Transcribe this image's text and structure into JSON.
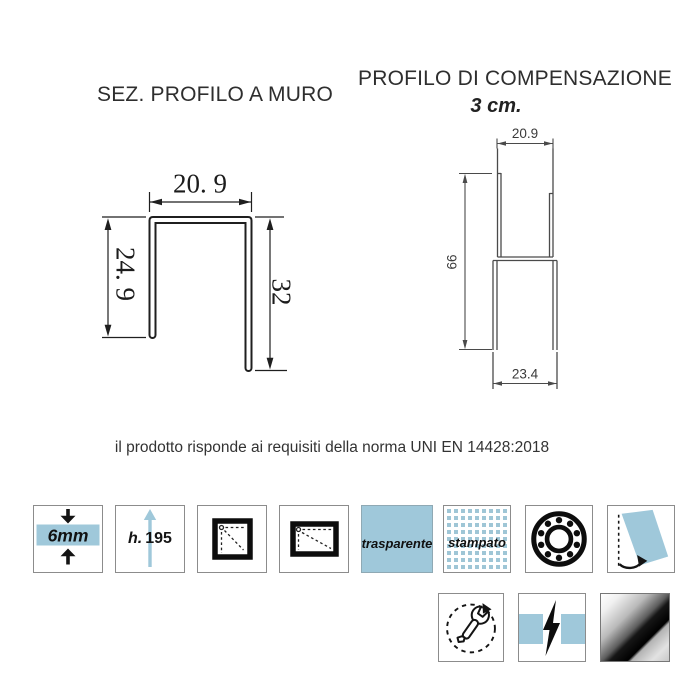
{
  "titles": {
    "left": "SEZ. PROFILO A MURO",
    "right": "PROFILO DI COMPENSAZIONE",
    "right_subtitle": "3 cm."
  },
  "wall_profile": {
    "width_top": "20. 9",
    "height_left": "24. 9",
    "height_right": "32"
  },
  "compensation_profile": {
    "width_top": "20.9",
    "height_left": "66",
    "width_bottom": "23.4"
  },
  "compliance": "il prodotto risponde ai requisiti della norma UNI EN 14428:2018",
  "features": {
    "glass_thickness": "6mm",
    "height_prefix": "h.",
    "height_value": "195",
    "glass_transparent": "trasparente",
    "glass_printed": "stampato"
  },
  "colors": {
    "accent_blue": "#9fc8da",
    "icon_border": "#8c8c8c",
    "line_dark": "#1f1f1f",
    "line_gray": "#4a4a4a"
  }
}
